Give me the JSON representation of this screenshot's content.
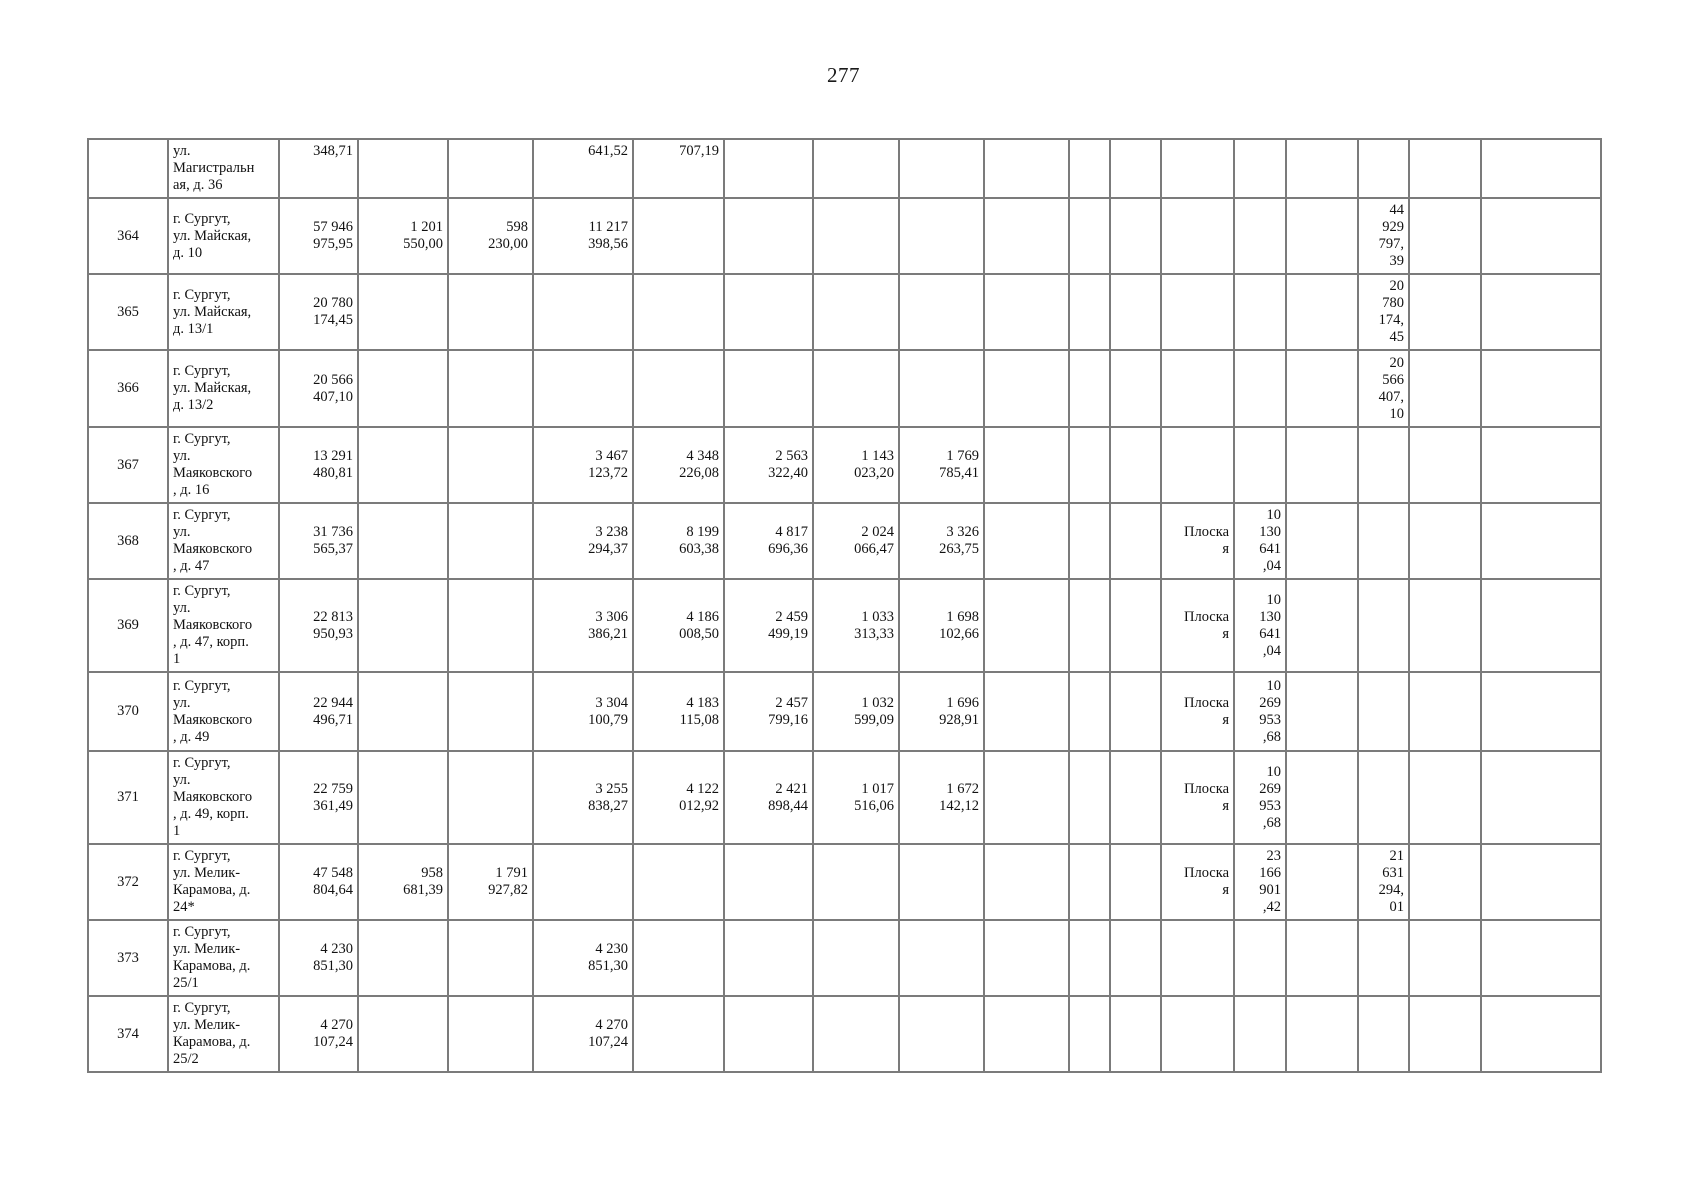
{
  "page": {
    "number": "277"
  },
  "table": {
    "rows": [
      {
        "cells": [
          "",
          "ул.\nМагистральн\nая, д. 36",
          "348,71",
          "",
          "",
          "641,52",
          "707,19",
          "",
          "",
          "",
          "",
          "",
          "",
          "",
          "",
          "",
          "",
          "",
          ""
        ]
      },
      {
        "cells": [
          "364",
          "г. Сургут,\nул. Майская,\nд. 10",
          "57 946\n975,95",
          "1 201\n550,00",
          "598\n230,00",
          "11 217\n398,56",
          "",
          "",
          "",
          "",
          "",
          "",
          "",
          "",
          "",
          "",
          "44\n929\n797,\n39",
          "",
          ""
        ]
      },
      {
        "cells": [
          "365",
          "г. Сургут,\nул. Майская,\nд. 13/1",
          "20 780\n174,45",
          "",
          "",
          "",
          "",
          "",
          "",
          "",
          "",
          "",
          "",
          "",
          "",
          "",
          "20\n780\n174,\n45",
          "",
          ""
        ]
      },
      {
        "cells": [
          "366",
          "г. Сургут,\nул. Майская,\nд. 13/2",
          "20 566\n407,10",
          "",
          "",
          "",
          "",
          "",
          "",
          "",
          "",
          "",
          "",
          "",
          "",
          "",
          "20\n566\n407,\n10",
          "",
          ""
        ]
      },
      {
        "cells": [
          "367",
          "г. Сургут,\nул.\nМаяковского\n, д. 16",
          "13 291\n480,81",
          "",
          "",
          "3 467\n123,72",
          "4 348\n226,08",
          "2 563\n322,40",
          "1 143\n023,20",
          "1 769\n785,41",
          "",
          "",
          "",
          "",
          "",
          "",
          "",
          "",
          ""
        ]
      },
      {
        "cells": [
          "368",
          "г. Сургут,\nул.\nМаяковского\n, д. 47",
          "31 736\n565,37",
          "",
          "",
          "3 238\n294,37",
          "8 199\n603,38",
          "4 817\n696,36",
          "2 024\n066,47",
          "3 326\n263,75",
          "",
          "",
          "",
          "Плоска\nя",
          "10\n130\n641\n,04",
          "",
          "",
          "",
          ""
        ]
      },
      {
        "cells": [
          "369",
          "г. Сургут,\nул.\nМаяковского\n, д. 47, корп.\n1",
          "22 813\n950,93",
          "",
          "",
          "3 306\n386,21",
          "4 186\n008,50",
          "2 459\n499,19",
          "1 033\n313,33",
          "1 698\n102,66",
          "",
          "",
          "",
          "Плоска\nя",
          "10\n130\n641\n,04",
          "",
          "",
          "",
          ""
        ]
      },
      {
        "cells": [
          "370",
          "г. Сургут,\nул.\nМаяковского\n, д. 49",
          "22 944\n496,71",
          "",
          "",
          "3 304\n100,79",
          "4 183\n115,08",
          "2 457\n799,16",
          "1 032\n599,09",
          "1 696\n928,91",
          "",
          "",
          "",
          "Плоска\nя",
          "10\n269\n953\n,68",
          "",
          "",
          "",
          ""
        ]
      },
      {
        "cells": [
          "371",
          "г. Сургут,\nул.\nМаяковского\n, д. 49, корп.\n1",
          "22 759\n361,49",
          "",
          "",
          "3 255\n838,27",
          "4 122\n012,92",
          "2 421\n898,44",
          "1 017\n516,06",
          "1 672\n142,12",
          "",
          "",
          "",
          "Плоска\nя",
          "10\n269\n953\n,68",
          "",
          "",
          "",
          ""
        ]
      },
      {
        "cells": [
          "372",
          "г. Сургут,\nул. Мелик-\nКарамова, д.\n24*",
          "47 548\n804,64",
          "958\n681,39",
          "1 791\n927,82",
          "",
          "",
          "",
          "",
          "",
          "",
          "",
          "",
          "Плоска\nя",
          "23\n166\n901\n,42",
          "",
          "21\n631\n294,\n01",
          "",
          ""
        ]
      },
      {
        "cells": [
          "373",
          "г. Сургут,\nул. Мелик-\nКарамова, д.\n25/1",
          "4 230\n851,30",
          "",
          "",
          "4 230\n851,30",
          "",
          "",
          "",
          "",
          "",
          "",
          "",
          "",
          "",
          "",
          "",
          "",
          ""
        ]
      },
      {
        "cells": [
          "374",
          "г. Сургут,\nул. Мелик-\nКарамова, д.\n25/2",
          "4 270\n107,24",
          "",
          "",
          "4 270\n107,24",
          "",
          "",
          "",
          "",
          "",
          "",
          "",
          "",
          "",
          "",
          "",
          "",
          ""
        ]
      }
    ]
  }
}
